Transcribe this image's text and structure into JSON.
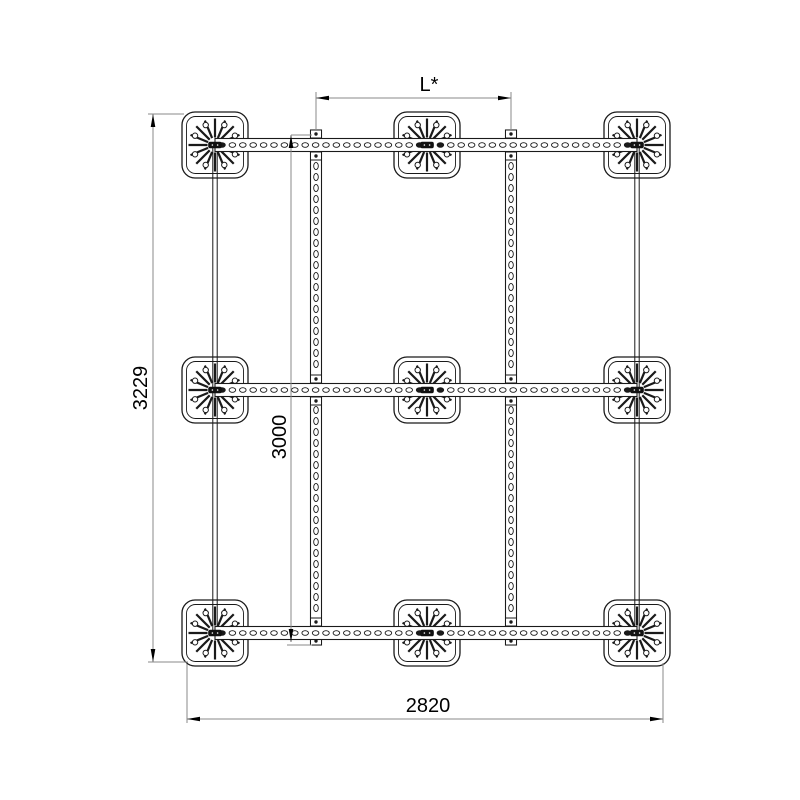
{
  "page": {
    "background": "#ffffff"
  },
  "drawing": {
    "type": "technical-diagram",
    "view": "top view of a mounting frame: 3x3 grid of base plates joined by perforated rails",
    "colors": {
      "line": "#1a1a1a",
      "dimension_line": "#8a8a8a",
      "text": "#000000",
      "fill": "#ffffff",
      "hub": "#111111"
    },
    "grid": {
      "rows": 3,
      "columns": 3,
      "plate_count": 9,
      "horizontal_rail_count": 3,
      "vertical_rail_count": 2
    },
    "dimensions": [
      {
        "id": "rail-spacing-top",
        "label": "L*",
        "orientation": "horizontal",
        "position": "top"
      },
      {
        "id": "overall-depth",
        "label": "3229",
        "orientation": "vertical",
        "position": "left"
      },
      {
        "id": "rail-axis-depth",
        "label": "3000",
        "orientation": "vertical",
        "position": "inner-left"
      },
      {
        "id": "overall-width",
        "label": "2820",
        "orientation": "horizontal",
        "position": "bottom"
      }
    ]
  }
}
